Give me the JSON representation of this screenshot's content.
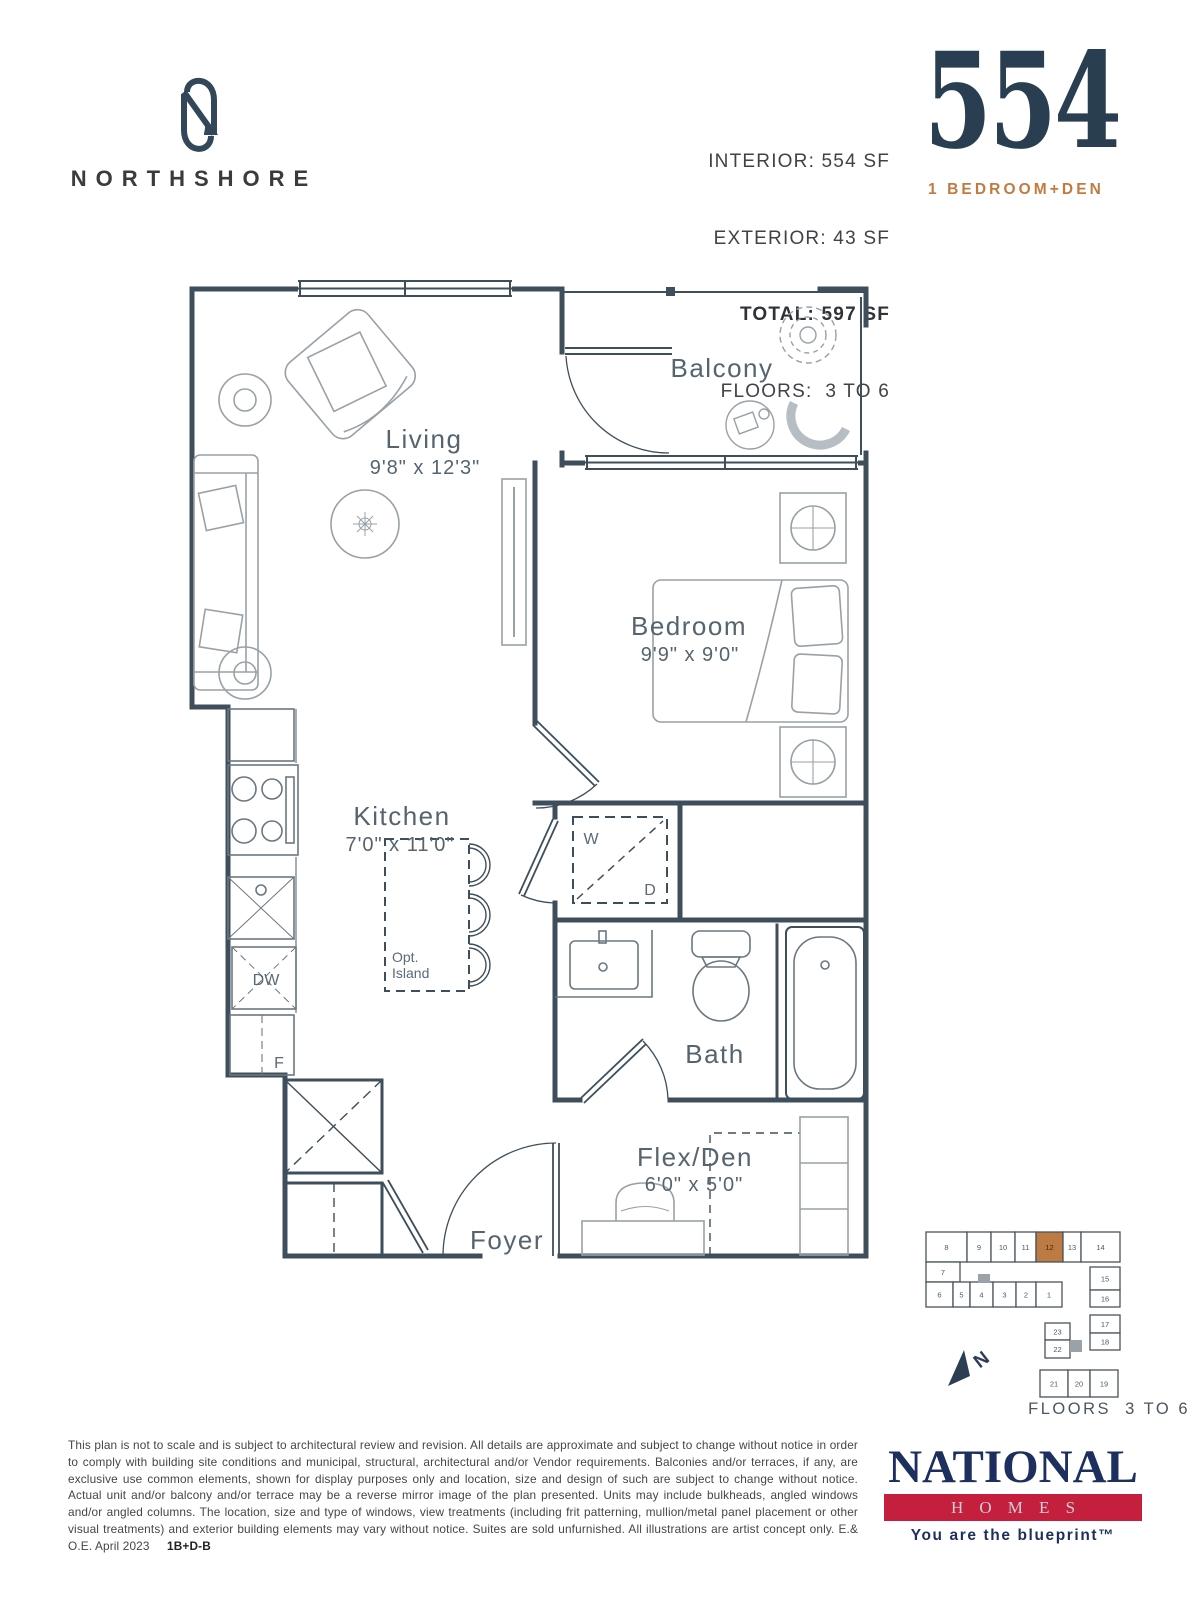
{
  "header": {
    "brand": "NORTHSHORE",
    "stat_line1": "INTERIOR: 554 SF",
    "stat_line2": "EXTERIOR: 43 SF",
    "stat_line3": "TOTAL: 597 SF",
    "stat_line4": "FLOORS:  3 TO 6",
    "unit_number": "554",
    "unit_type": "1 BEDROOM+DEN"
  },
  "plan": {
    "rooms": {
      "living_name": "Living",
      "living_dims": "9'8\" x 12'3\"",
      "balcony_name": "Balcony",
      "bedroom_name": "Bedroom",
      "bedroom_dims": "9'9\" x 9'0\"",
      "kitchen_name": "Kitchen",
      "kitchen_dims": "7'0\" x 11'0\"",
      "bath_name": "Bath",
      "flexden_name": "Flex/Den",
      "flexden_dims": "6'0\" x 5'0\"",
      "foyer_name": "Foyer"
    },
    "labels": {
      "washer": "W",
      "dryer": "D",
      "dishwasher": "DW",
      "fridge": "F",
      "island_line1": "Opt.",
      "island_line2": "Island"
    }
  },
  "keyplan": {
    "floors_label": "FLOORS  3 TO 6",
    "highlight_unit": "12",
    "highlight_color": "#bd7a42",
    "north_label": "N",
    "units": [
      {
        "n": "8",
        "x": 36,
        "y": 42,
        "w": 41,
        "h": 30
      },
      {
        "n": "9",
        "x": 77,
        "y": 42,
        "w": 24,
        "h": 30
      },
      {
        "n": "10",
        "x": 101,
        "y": 42,
        "w": 24,
        "h": 30
      },
      {
        "n": "11",
        "x": 125,
        "y": 42,
        "w": 21,
        "h": 30
      },
      {
        "n": "12",
        "x": 146,
        "y": 42,
        "w": 27,
        "h": 30,
        "highlight": true
      },
      {
        "n": "13",
        "x": 173,
        "y": 42,
        "w": 18,
        "h": 30
      },
      {
        "n": "14",
        "x": 191,
        "y": 42,
        "w": 39,
        "h": 30
      },
      {
        "n": "7",
        "x": 36,
        "y": 72,
        "w": 34,
        "h": 20
      },
      {
        "n": "6",
        "x": 36,
        "y": 92,
        "w": 27,
        "h": 25
      },
      {
        "n": "5",
        "x": 63,
        "y": 92,
        "w": 17,
        "h": 25
      },
      {
        "n": "4",
        "x": 80,
        "y": 92,
        "w": 23,
        "h": 25
      },
      {
        "n": "3",
        "x": 103,
        "y": 92,
        "w": 23,
        "h": 25
      },
      {
        "n": "2",
        "x": 126,
        "y": 92,
        "w": 20,
        "h": 25
      },
      {
        "n": "1",
        "x": 146,
        "y": 92,
        "w": 26,
        "h": 25
      },
      {
        "n": "15",
        "x": 200,
        "y": 77,
        "w": 30,
        "h": 23
      },
      {
        "n": "16",
        "x": 200,
        "y": 100,
        "w": 30,
        "h": 17
      },
      {
        "n": "17",
        "x": 200,
        "y": 125,
        "w": 30,
        "h": 18
      },
      {
        "n": "18",
        "x": 200,
        "y": 143,
        "w": 30,
        "h": 17
      },
      {
        "n": "23",
        "x": 155,
        "y": 133,
        "w": 25,
        "h": 17
      },
      {
        "n": "22",
        "x": 155,
        "y": 150,
        "w": 25,
        "h": 18
      },
      {
        "n": "21",
        "x": 150,
        "y": 180,
        "w": 28,
        "h": 27
      },
      {
        "n": "20",
        "x": 178,
        "y": 180,
        "w": 22,
        "h": 27
      },
      {
        "n": "19",
        "x": 200,
        "y": 180,
        "w": 28,
        "h": 27
      }
    ]
  },
  "footer": {
    "disclaimer": "This plan is not to scale and is subject to architectural review and revision. All details are approximate and subject to change without notice in order to comply with building site conditions and municipal, structural, architectural and/or Vendor requirements. Balconies and/or terraces, if any, are exclusive use common elements, shown for display purposes only and location, size and design of such are subject to change without notice. Actual unit and/or balcony and/or terrace may be a reverse mirror image of the plan presented. Units may include bulkheads, angled windows and/or angled columns. The location, size and type of windows, view treatments (including frit patterning, mullion/metal panel placement or other visual treatments) and exterior building elements may vary without notice. Suites are sold unfurnished. All illustrations are artist concept only. E.& O.E. April 2023",
    "plan_code": "1B+D-B",
    "logo_name": "NATIONAL",
    "logo_sub": "HOMES",
    "logo_tagline": "You are the blueprint™"
  },
  "colors": {
    "navy": "#2a3e52",
    "accent_orange": "#c17b40",
    "wall": "#3f4e5b",
    "furniture": "#98a1a8",
    "logo_red": "#c41f3d",
    "logo_navy": "#1d2f5f"
  }
}
